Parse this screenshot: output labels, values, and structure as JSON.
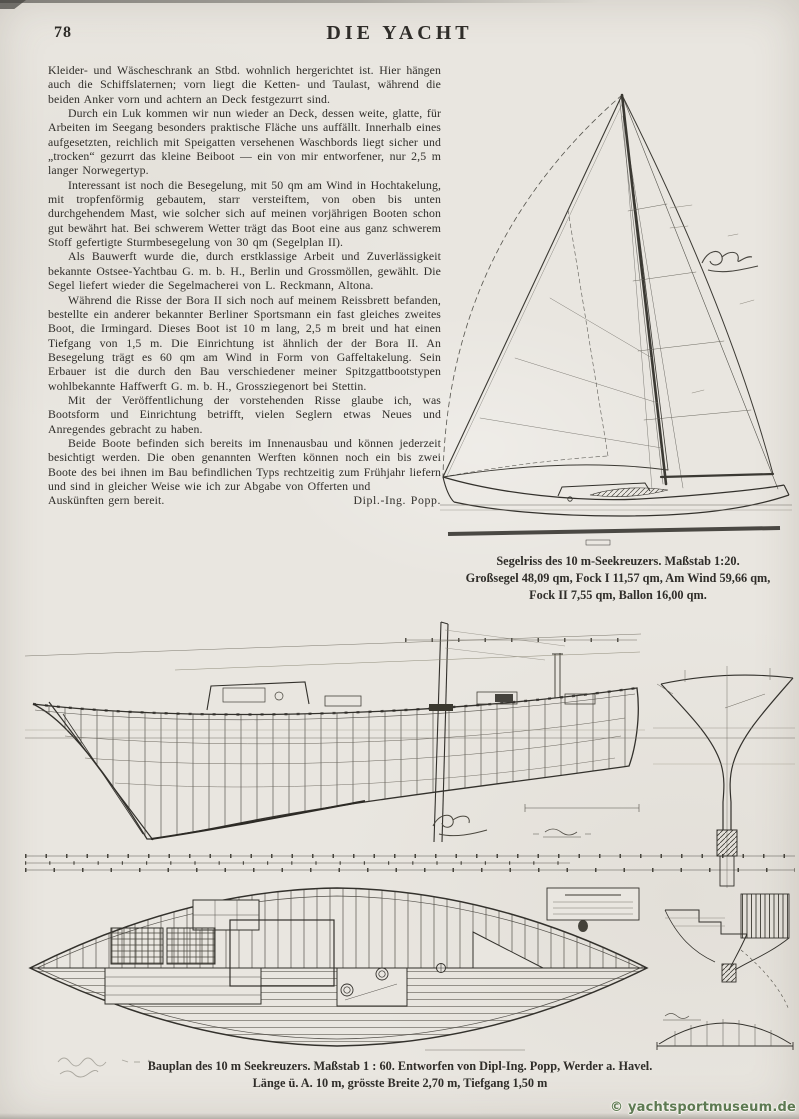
{
  "page": {
    "page_number": "78",
    "masthead": "DIE YACHT"
  },
  "article": {
    "paragraphs": [
      "Kleider- und Wäscheschrank an Stbd. wohnlich hergerichtet ist. Hier hängen auch die Schiffslaternen; vorn liegt die Ketten- und Taulast, während die beiden Anker vorn und achtern an Deck festgezurrt sind.",
      "Durch ein Luk kommen wir nun wieder an Deck, dessen weite, glatte, für Arbeiten im Seegang besonders praktische Fläche uns auffällt. Innerhalb eines aufgesetzten, reichlich mit Speigatten versehenen Waschbords liegt sicher und „trocken“ gezurrt das kleine Beiboot — ein von mir entworfener, nur 2,5 m langer Norwegertyp.",
      "Interessant ist noch die Besegelung, mit 50 qm am Wind in Hochtakelung, mit tropfenförmig gebautem, starr versteiftem, von oben bis unten durchgehendem Mast, wie solcher sich auf meinen vorjährigen Booten schon gut bewährt hat. Bei schwerem Wetter trägt das Boot eine aus ganz schwerem Stoff gefertigte Sturmbesegelung von 30 qm (Segelplan II).",
      "Als Bauwerft wurde die, durch erstklassige Arbeit und Zuverlässigkeit bekannte Ostsee-Yachtbau G. m. b. H., Berlin und Grossmöllen, gewählt. Die Segel liefert wieder die Segelmacherei von L. Reckmann, Altona.",
      "Während die Risse der Bora II sich noch auf meinem Reissbrett befanden, bestellte ein anderer bekannter Berliner Sportsmann ein fast gleiches zweites Boot, die Irmingard. Dieses Boot ist 10 m lang, 2,5 m breit und hat einen Tiefgang von 1,5 m. Die Einrichtung ist ähnlich der der Bora II. An Besegelung trägt es 60 qm am Wind in Form von Gaffeltakelung. Sein Erbauer ist die durch den Bau verschiedener meiner Spitzgattbootstypen wohlbekannte Haffwerft G. m. b. H., Grossziegenort bei Stettin.",
      "Mit der Veröffentlichung der vorstehenden Risse glaube ich, was Bootsform und Einrichtung betrifft, vielen Seglern etwas Neues und Anregendes gebracht zu haben.",
      "Beide Boote befinden sich bereits im Innenausbau und können jederzeit besichtigt werden. Die oben genannten Werften können noch ein bis zwei Boote des bei ihnen im Bau befindlichen Typs rechtzeitig zum Frühjahr liefern und sind in gleicher Weise wie ich zur Abgabe von Offerten und"
    ],
    "closing_line": "Auskünften gern bereit.",
    "signature": "Dipl.-Ing. Popp."
  },
  "sail_plan_figure": {
    "caption_title": "Segelriss des 10 m-Seekreuzers.",
    "caption_scale": "Maßstab 1:20.",
    "caption_line2": "Großsegel 48,09 qm, Fock I 11,57 qm, Am Wind 59,66 qm,",
    "caption_line3": "Fock II 7,55 qm, Ballon 16,00 qm."
  },
  "bauplan_figure": {
    "caption_title": "Bauplan des 10 m Seekreuzers.",
    "caption_rest": "Maßstab 1 : 60.  Entworfen von Dipl-Ing. Popp, Werder a. Havel.",
    "caption_line2": "Länge ü. A. 10 m, grösste Breite 2,70 m,  Tiefgang 1,50 m"
  },
  "watermark": "© yachtsportmuseum.de",
  "colors": {
    "paper": "#e9e6e0",
    "ink": "#2f2d29",
    "drawing_ink": "#3b3933",
    "watermark_green": "#5d7a52"
  }
}
